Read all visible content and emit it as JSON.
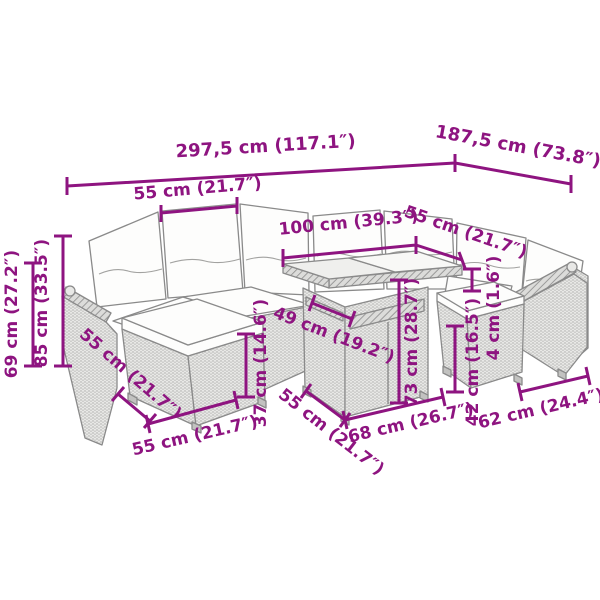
{
  "diagram": {
    "description": "Line drawing of a 10-piece poly rattan garden lounge set (corner sofas, cushions, ottomans and a cube table) annotated with magenta dimension lines",
    "colors": {
      "accent": "#8E1480",
      "line": "#8a8a8a"
    },
    "dimensions": [
      {
        "id": "total-width",
        "label": "297,5 cm (117.1″)"
      },
      {
        "id": "total-depth",
        "label": "187,5 cm (73.8″)"
      },
      {
        "id": "back-cushion-width",
        "label": "55 cm (21.7″)"
      },
      {
        "id": "table-top-width",
        "label": "100 cm (39.3″)"
      },
      {
        "id": "table-top-depth",
        "label": "55 cm (21.7″)"
      },
      {
        "id": "cushion-thickness",
        "label": "4 cm (1.6″)"
      },
      {
        "id": "armrest-height",
        "label": "69 cm (27.2″)"
      },
      {
        "id": "total-height",
        "label": "85 cm (33.5″)"
      },
      {
        "id": "seat-depth-left",
        "label": "55 cm (21.7″)"
      },
      {
        "id": "seat-width-front",
        "label": "55 cm (21.7″)"
      },
      {
        "id": "seat-height",
        "label": "37 cm (14.6″)"
      },
      {
        "id": "under-table-width",
        "label": "49 cm (19.2″)"
      },
      {
        "id": "table-base-depth",
        "label": "55 cm (21.7″)"
      },
      {
        "id": "table-base-width",
        "label": "68 cm (26.7″)"
      },
      {
        "id": "table-height",
        "label": "73 cm (28.7″)"
      },
      {
        "id": "stool-height",
        "label": "42 cm (16.5″)"
      },
      {
        "id": "stool-width",
        "label": "62 cm (24.4″)"
      }
    ]
  }
}
